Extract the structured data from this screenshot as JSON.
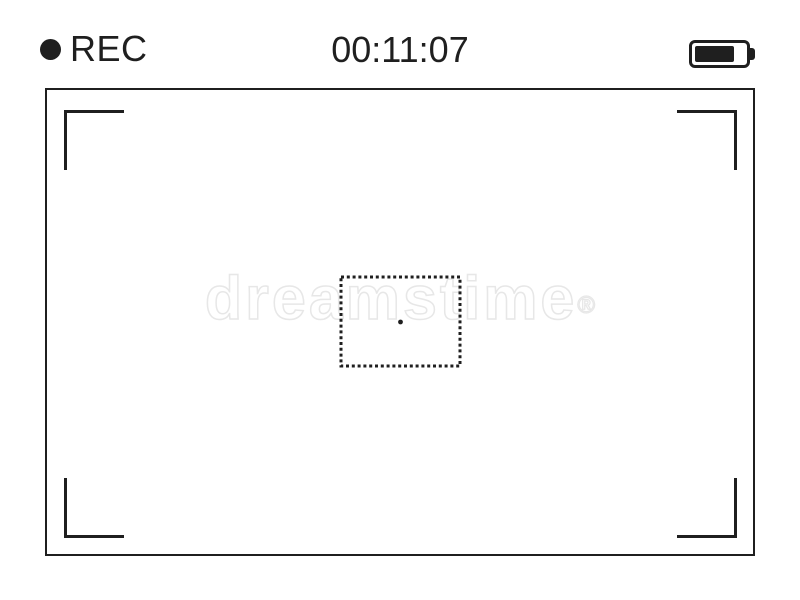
{
  "viewfinder": {
    "rec": {
      "label": "REC"
    },
    "timestamp": "00:11:07",
    "battery": {
      "fill_percent": 70
    },
    "colors": {
      "ink": "#1f1f1f",
      "background": "#ffffff"
    }
  },
  "watermark": {
    "text": "dreamstime",
    "symbol": "®",
    "color": "#e7e7e7"
  }
}
